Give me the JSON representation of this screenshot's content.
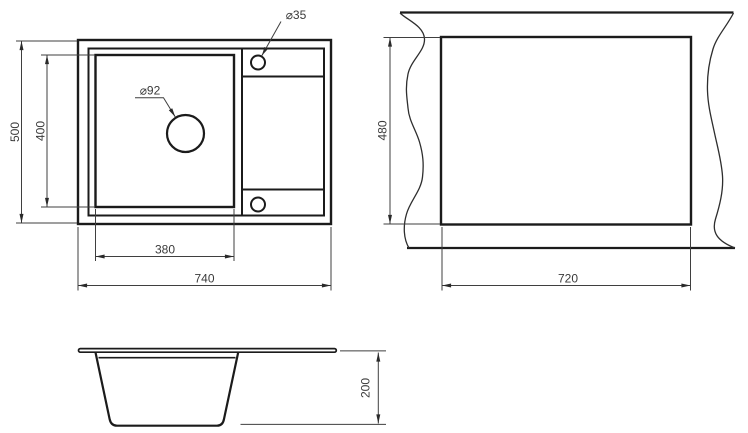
{
  "drawing": {
    "kind": "sink technical drawing",
    "units_implied": "mm"
  },
  "plan_view": {
    "overall_width": "740",
    "overall_depth": "500",
    "bowl_width": "380",
    "bowl_depth": "400",
    "drain_diameter": "⌀92",
    "tap_hole_diameter": "⌀35"
  },
  "cutout_view": {
    "cutout_width": "720",
    "cutout_depth": "480"
  },
  "side_view": {
    "bowl_height": "200"
  },
  "colors": {
    "object_line": "#1b1b1b",
    "dimension_line": "#3f3f3f",
    "text": "#3a3a3a",
    "background": "#ffffff"
  }
}
